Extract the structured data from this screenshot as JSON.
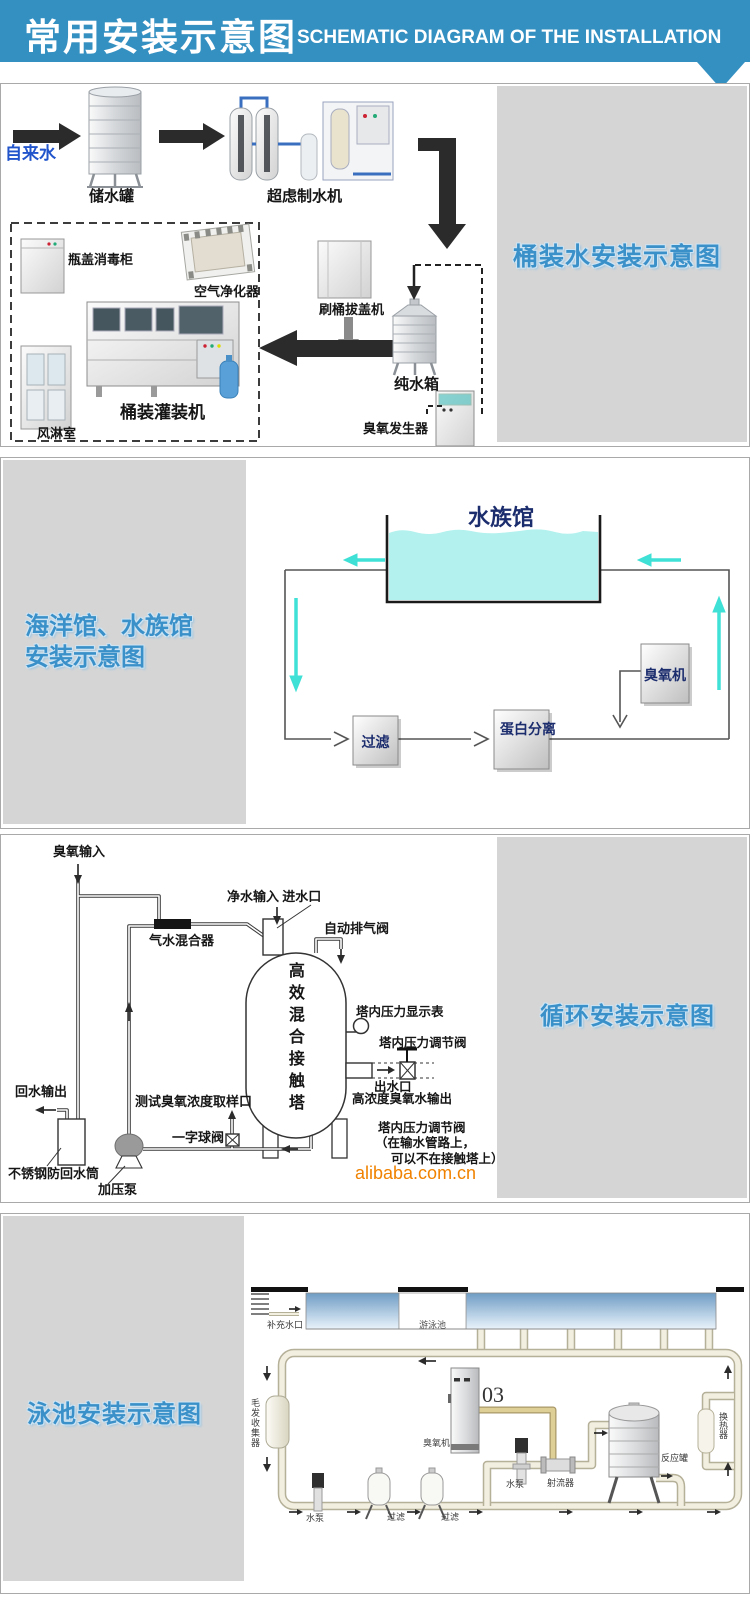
{
  "header": {
    "title_zh": "常用安装示意图",
    "title_en": "SCHEMATIC DIAGRAM OF THE INSTALLATION"
  },
  "sec1": {
    "title": "桶装水安装示意图",
    "labels": {
      "tap_water": "自来水",
      "storage_tank": "储水罐",
      "uf_machine": "超虑制水机",
      "cap_sterilizer": "瓶盖消毒柜",
      "air_purifier": "空气净化器",
      "brush_decap_machine": "刷桶拔盖机",
      "filling_machine": "桶装灌装机",
      "air_shower": "风淋室",
      "pure_water_tank": "纯水箱",
      "ozone_generator": "臭氧发生器"
    }
  },
  "sec2": {
    "title_line1": "海洋馆、水族馆",
    "title_line2": "安装示意图",
    "labels": {
      "aquarium": "水族馆",
      "filter": "过滤",
      "protein_separation": "蛋白分离",
      "ozone_machine": "臭氧机"
    }
  },
  "sec3": {
    "title": "循环安装示意图",
    "labels": {
      "ozone_input": "臭氧输入",
      "clean_water_input": "净水输入 进水口",
      "auto_exhaust_valve": "自动排气阀",
      "gas_water_mixer": "气水混合器",
      "contact_tower": "高效混合接触塔",
      "pressure_gauge": "塔内压力显示表",
      "pressure_regulating_valve": "塔内压力调节阀",
      "water_outlet": "出水口",
      "ozone_water_output": "高浓度臭氧水输出",
      "valve_note_line1": "塔内压力调节阀",
      "valve_note_line2": "（在输水管路上，",
      "valve_note_line3": "可以不在接触塔上）",
      "return_water_output": "回水输出",
      "sampling_port": "测试臭氧浓度取样口",
      "ball_valve": "一字球阀",
      "anti_backflow_cylinder": "不锈钢防回水筒",
      "pressure_pump": "加压泵"
    },
    "watermark": "alibaba.com.cn"
  },
  "sec4": {
    "title": "泳池安装示意图",
    "labels": {
      "supply_inlet": "补充水口",
      "swimming_pool": "游泳池",
      "hair_collector": "毛发收集器",
      "ozone_machine": "臭氧机",
      "o3": "03",
      "pump_mid": "水泵",
      "injector": "射流器",
      "reaction_tank": "反应罐",
      "heat_exchanger": "换热器",
      "pump_left": "水泵",
      "filter_1": "过滤",
      "filter_2": "过滤"
    }
  },
  "colors": {
    "header_bg": "#3590c2",
    "section_title_blue": "#3a90c8",
    "panel_gray": "#d5d5d5",
    "aquarium_navy": "#1c2d6e",
    "water_cyan": "#b2f1ee",
    "arrow_cyan": "#3fe0d6",
    "alibaba_orange": "#f08200",
    "pipe_cream": "#f2eee0",
    "pipe_tan": "#c9b97f",
    "tap_water_blue": "#2255cc"
  }
}
